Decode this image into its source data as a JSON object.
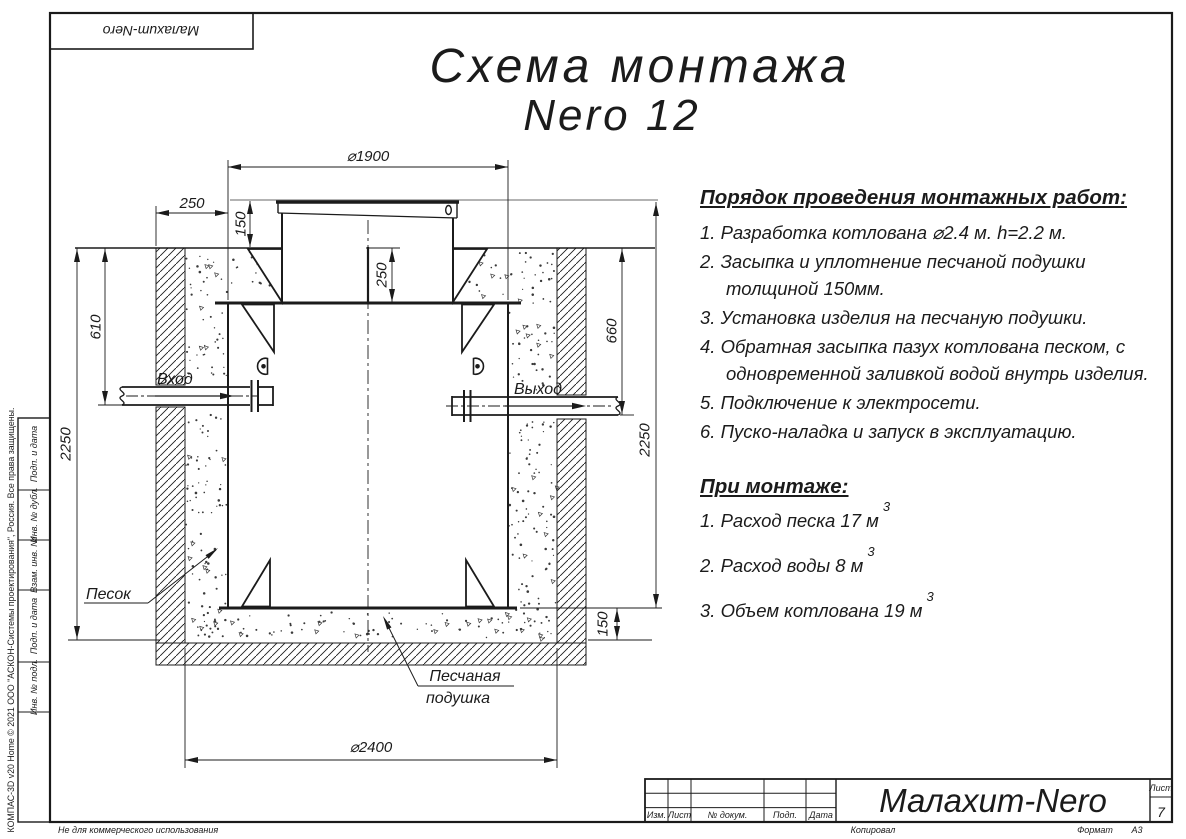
{
  "sheet": {
    "top_stamp": "Малахит-Nero",
    "title_line1": "Схема монтажа",
    "title_line2": "Nero 12",
    "left_margin_note": "КОМПАС-3D v20 Home © 2021 ООО \"АСКОН-Системы проектирования\", Россия. Все права защищены.",
    "footer_note": "Не для коммерческого использования",
    "footer_copy": "Копировал",
    "footer_format": "Формат",
    "footer_format_value": "А3",
    "side_stamps": [
      "Подп. и дата",
      "Инв. № дубл.",
      "Взам. инв. №",
      "Подп. и дата",
      "Инв. № подл."
    ]
  },
  "title_block": {
    "columns": [
      "Изм.",
      "Лист",
      "№ докум.",
      "Подп.",
      "Дата"
    ],
    "doc_name": "Малахит-Nero",
    "sheet_label": "Лист",
    "sheet_number": "7"
  },
  "instructions": {
    "heading": "Порядок проведения монтажных работ:",
    "items": [
      "1. Разработка котлована ⌀2.4 м. h=2.2 м.",
      "2. Засыпка и уплотнение песчаной подушки толщиной 150мм.",
      "3. Установка изделия на песчаную подушки.",
      "4. Обратная засыпка пазух котлована песком, с одновременной заливкой водой внутрь изделия.",
      "5. Подключение к электросети.",
      "6. Пуско-наладка и запуск в эксплуатацию."
    ]
  },
  "montage": {
    "heading": "При монтаже:",
    "items": [
      {
        "text": "1. Расход песка 17 м",
        "sup": "3"
      },
      {
        "text": "2. Расход воды 8 м",
        "sup": "3"
      },
      {
        "text": "3. Объем котлована 19 м",
        "sup": "3"
      }
    ]
  },
  "drawing": {
    "inlet_label": "Вход",
    "outlet_label": "Выход",
    "sand_label": "Песок",
    "cushion_label_line1": "Песчаная",
    "cushion_label_line2": "подушка",
    "dims": {
      "body_diameter": "⌀1900",
      "pit_diameter": "⌀2400",
      "side_gap": "250",
      "lid_height": "150",
      "neck_depth": "250",
      "inlet_depth": "610",
      "outlet_depth": "660",
      "depth_left": "2250",
      "height_right": "2250",
      "cushion_thickness": "150"
    }
  }
}
